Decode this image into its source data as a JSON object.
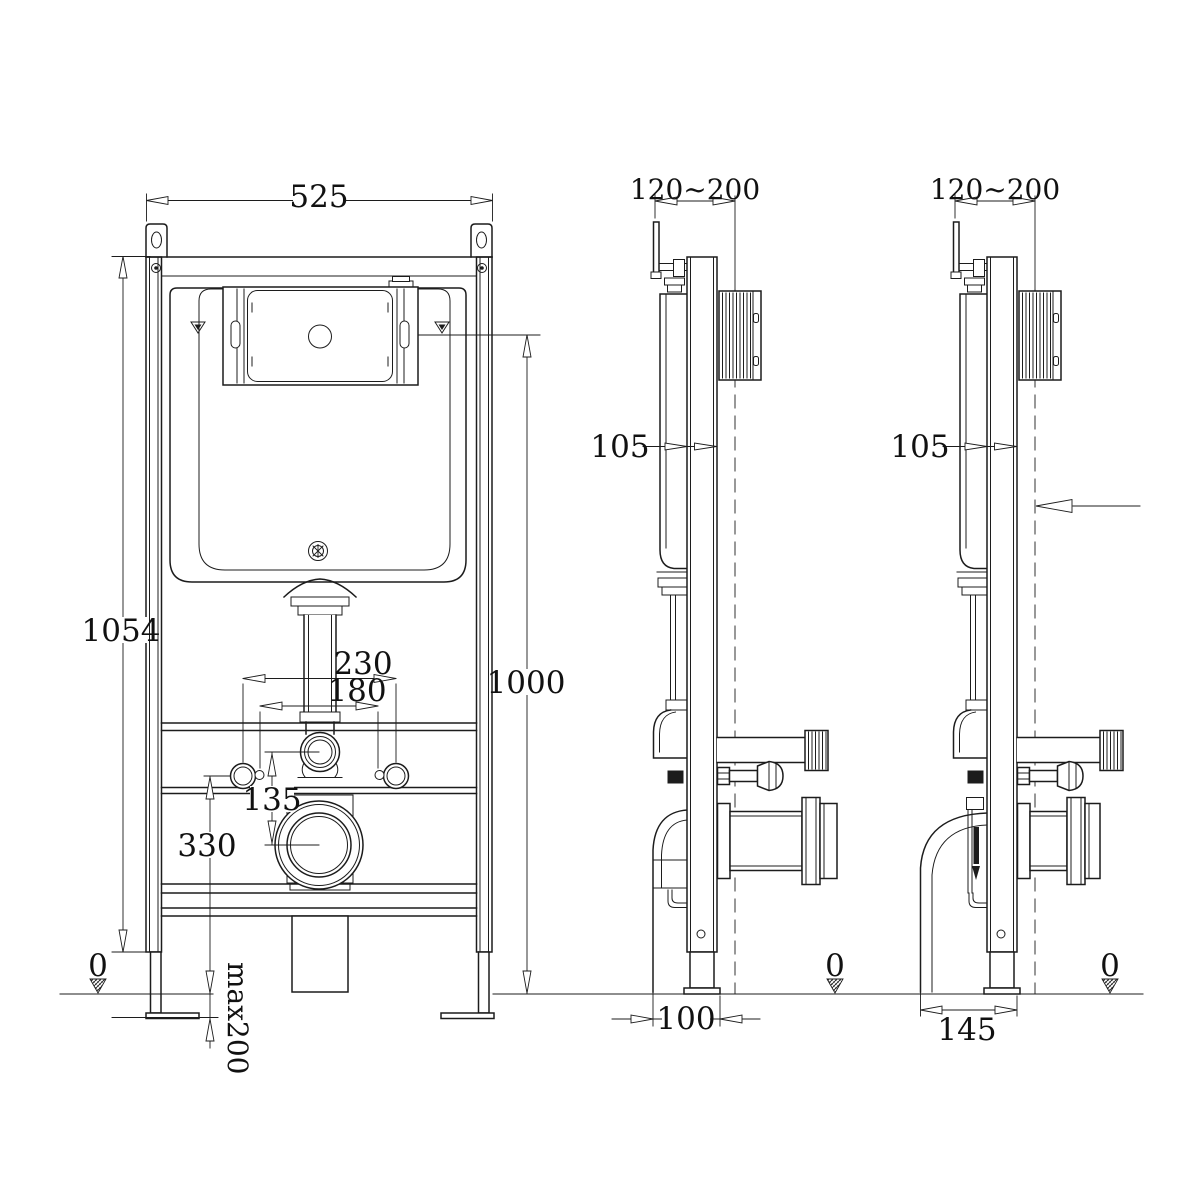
{
  "drawing": {
    "front_view": {
      "width": "525",
      "frame_height": "1054",
      "flush_height": "1000",
      "fixing_spacing_outer": "230",
      "fixing_spacing_inner": "180",
      "flush_to_drain_offset": "135",
      "fixing_height": "330",
      "floor_level": "0",
      "max_leg_extension": "max200"
    },
    "side_view_left": {
      "install_depth_range": "120~200",
      "frame_depth": "105",
      "drain_clearance": "100",
      "floor_level": "0"
    },
    "side_view_right": {
      "install_depth_range": "120~200",
      "frame_depth": "105",
      "drain_clearance": "145",
      "floor_level": "0"
    }
  }
}
